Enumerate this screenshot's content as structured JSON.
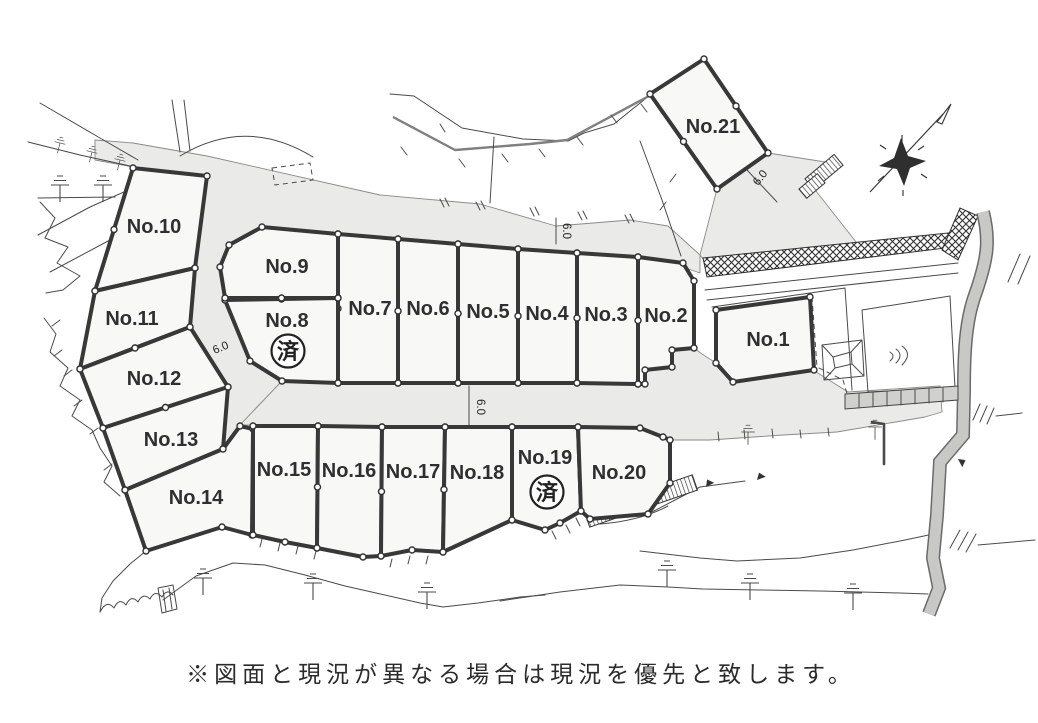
{
  "note": "※図面と現況が異なる場合は現況を優先と致します。",
  "sold_label": "済",
  "colors": {
    "lot_fill": "#f8f8f6",
    "road_fill": "#eaeae8",
    "boundary": "#383838",
    "terrain_line": "#4a4a4a",
    "wall_fill": "#d0d0ce"
  },
  "road_width_labels": [
    {
      "text": "6.0",
      "x": 563,
      "y": 231,
      "rot": 90
    },
    {
      "text": "6.0",
      "x": 477,
      "y": 407,
      "rot": 90
    },
    {
      "text": "6.0",
      "x": 222,
      "y": 351,
      "rot": -23
    },
    {
      "text": "6.0",
      "x": 763,
      "y": 180,
      "rot": -52
    }
  ],
  "lots": [
    {
      "id": 1,
      "label": "No.1",
      "lx": 768,
      "ly": 346,
      "sold": false,
      "points": "716,310 810,297 814,370 733,382 716,363"
    },
    {
      "id": 2,
      "label": "No.2",
      "lx": 666,
      "ly": 322,
      "sold": false,
      "points": "638,257 683,263 694,281 694,348 672,350 672,367 645,370 645,384 638,384"
    },
    {
      "id": 3,
      "label": "No.3",
      "lx": 606,
      "ly": 321,
      "sold": false,
      "points": "577,253 638,257 638,384 577,383"
    },
    {
      "id": 4,
      "label": "No.4",
      "lx": 547,
      "ly": 320,
      "sold": false,
      "points": "518,249 577,253 577,383 518,383"
    },
    {
      "id": 5,
      "label": "No.5",
      "lx": 488,
      "ly": 318,
      "sold": false,
      "points": "458,244 518,249 518,383 458,383"
    },
    {
      "id": 6,
      "label": "No.6",
      "lx": 428,
      "ly": 315,
      "sold": false,
      "points": "398,239 458,244 458,383 398,383"
    },
    {
      "id": 7,
      "label": "No.7",
      "lx": 370,
      "ly": 315,
      "sold": false,
      "points": "338,234 398,239 398,383 338,383"
    },
    {
      "id": 8,
      "label": "No.8",
      "lx": 287,
      "ly": 327,
      "sold": true,
      "sx": 288,
      "sy": 351,
      "points": "225,300 338,298 338,383 282,381 250,361"
    },
    {
      "id": 9,
      "label": "No.9",
      "lx": 287,
      "ly": 273,
      "sold": false,
      "points": "262,227 338,234 338,298 225,298 220,267 229,245"
    },
    {
      "id": 10,
      "label": "No.10",
      "lx": 154,
      "ly": 233,
      "sold": false,
      "points": "133,168 207,176 195,268 95,291"
    },
    {
      "id": 11,
      "label": "No.11",
      "lx": 132,
      "ly": 325,
      "sold": false,
      "points": "95,291 195,268 190,327 80,369"
    },
    {
      "id": 12,
      "label": "No.12",
      "lx": 154,
      "ly": 385,
      "sold": false,
      "points": "80,369 190,327 228,387 103,428"
    },
    {
      "id": 13,
      "label": "No.13",
      "lx": 171,
      "ly": 446,
      "sold": false,
      "points": "103,428 228,387 223,449 125,490"
    },
    {
      "id": 14,
      "label": "No.14",
      "lx": 196,
      "ly": 504,
      "sold": false,
      "points": "125,490 223,449 240,426 253,429 252,535 222,527 146,551"
    },
    {
      "id": 15,
      "label": "No.15",
      "lx": 284,
      "ly": 476,
      "sold": false,
      "points": "253,426 318,426 317,548 285,542 253,535"
    },
    {
      "id": 16,
      "label": "No.16",
      "lx": 349,
      "ly": 477,
      "sold": false,
      "points": "318,426 382,427 381,556 363,557 317,548"
    },
    {
      "id": 17,
      "label": "No.17",
      "lx": 413,
      "ly": 478,
      "sold": false,
      "points": "382,427 445,427 443,552 412,550 381,556"
    },
    {
      "id": 18,
      "label": "No.18",
      "lx": 477,
      "ly": 479,
      "sold": false,
      "points": "445,427 512,427 512,520 443,552"
    },
    {
      "id": 19,
      "label": "No.19",
      "lx": 545,
      "ly": 464,
      "sold": true,
      "sx": 547,
      "sy": 492,
      "points": "512,427 578,427 581,511 560,523 545,530 512,520"
    },
    {
      "id": 20,
      "label": "No.20",
      "lx": 619,
      "ly": 479,
      "sold": false,
      "points": "578,427 640,428 663,437 670,440 670,483 648,514 590,519 581,511"
    },
    {
      "id": 21,
      "label": "No.21",
      "lx": 713,
      "ly": 133,
      "sold": false,
      "points": "650,94 704,59 768,153 717,189"
    }
  ]
}
